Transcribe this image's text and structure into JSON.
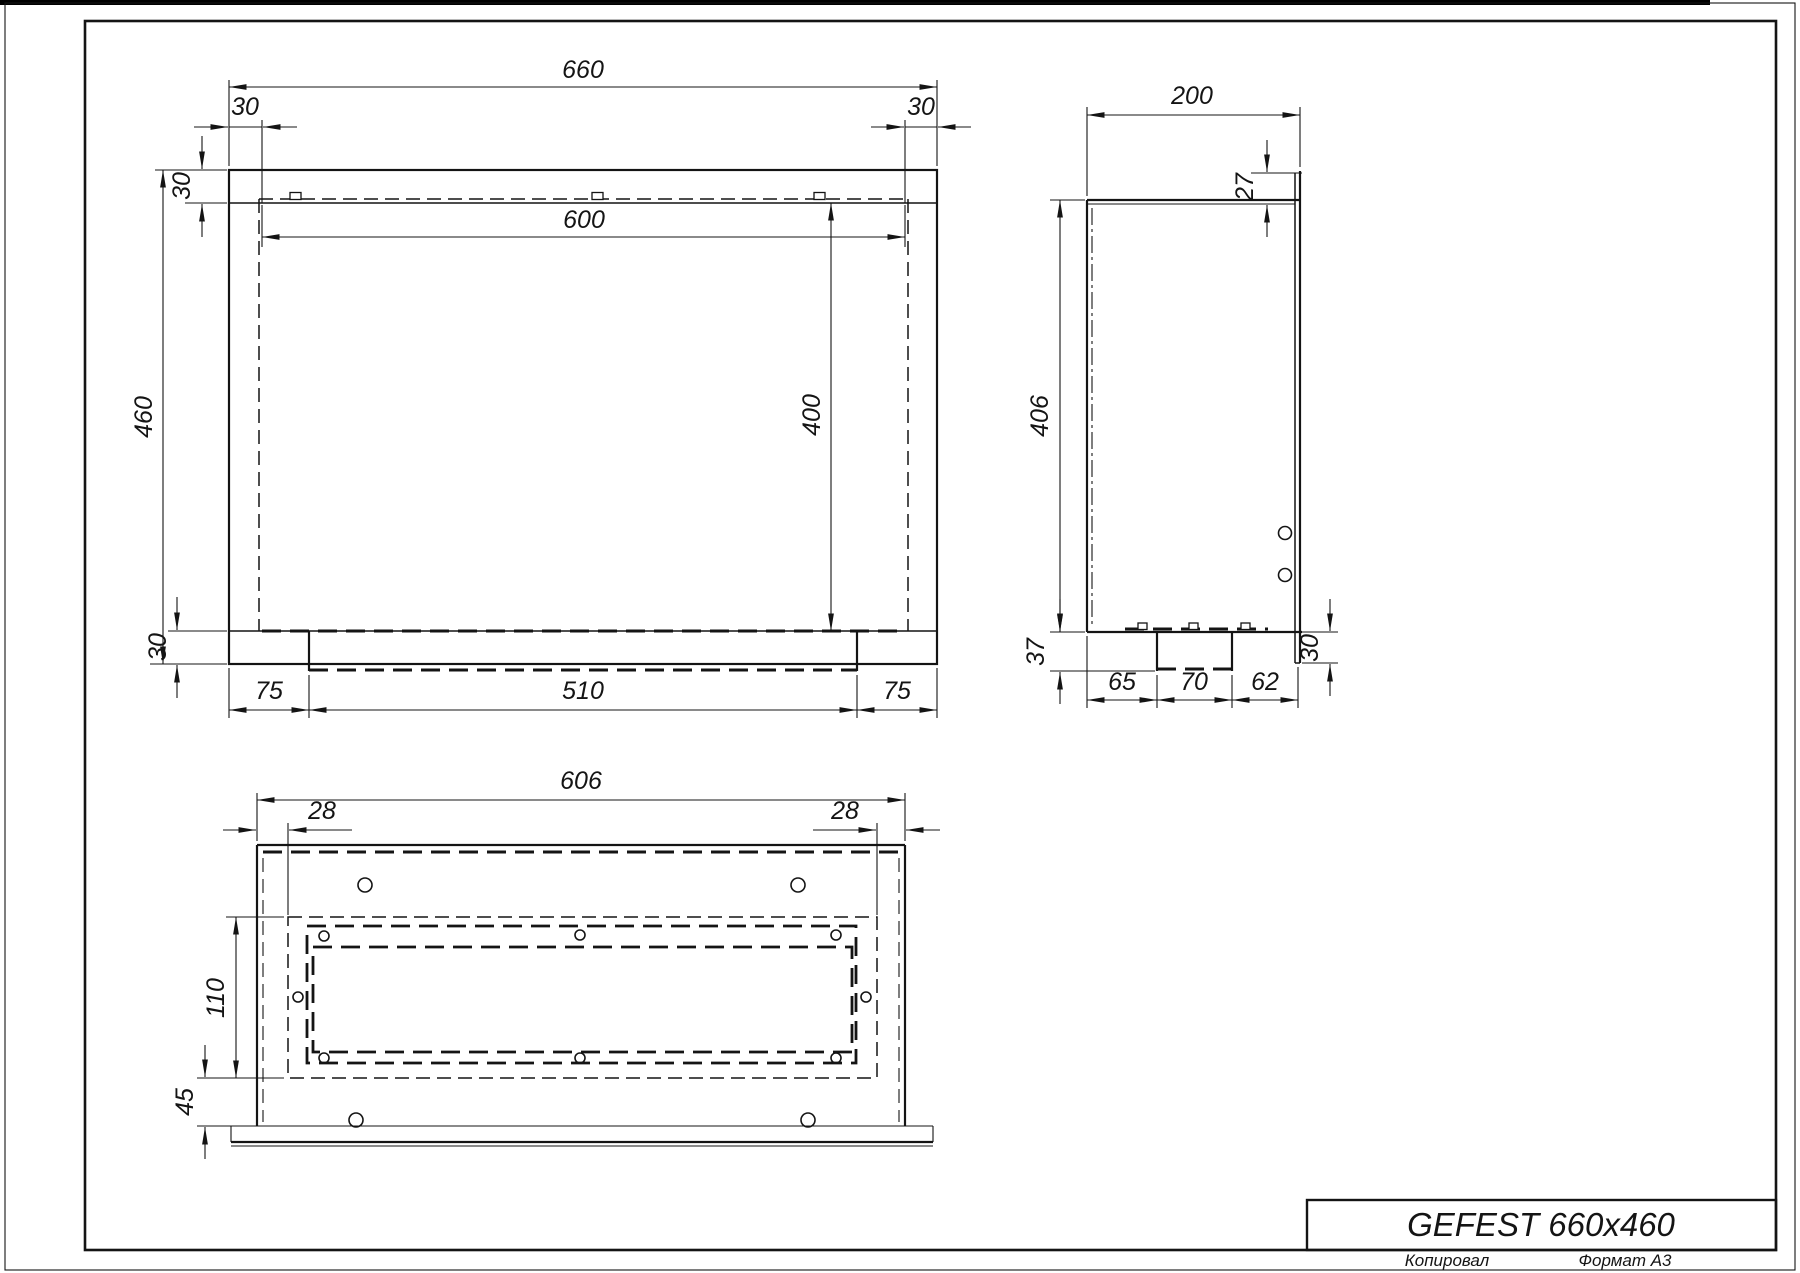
{
  "sheet": {
    "copied_label": "Копировал",
    "format_label": "Формат А3"
  },
  "title_block": {
    "title": "GEFEST 660x460"
  },
  "front_view": {
    "dims": {
      "total_width": "660",
      "margin_left": "30",
      "margin_right": "30",
      "top_flange": "30",
      "opening_width": "600",
      "total_height": "460",
      "opening_height": "400",
      "bottom_flange": "30",
      "tray_offset_left": "75",
      "tray_width": "510",
      "tray_offset_right": "75"
    }
  },
  "side_view": {
    "dims": {
      "depth": "200",
      "top_lip": "27",
      "height": "406",
      "tab_depth": "37",
      "front_segment": "65",
      "tab_width": "70",
      "rear_segment": "62",
      "flange_drop": "30"
    }
  },
  "bottom_view": {
    "dims": {
      "flange_width": "606",
      "margin_left": "28",
      "margin_right": "28",
      "slot_depth": "110",
      "front_offset": "45"
    }
  }
}
